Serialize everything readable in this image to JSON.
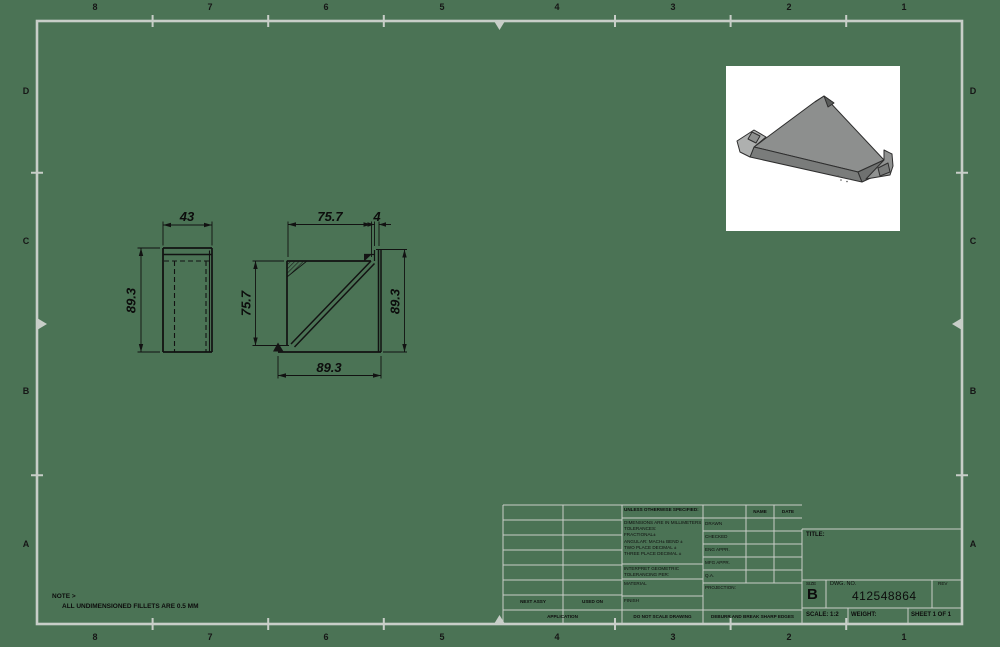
{
  "sheet": {
    "background_color": "#4b7355",
    "border_color": "#c8cec8",
    "line_color": "#121212",
    "zone_columns": [
      "8",
      "7",
      "6",
      "5",
      "4",
      "3",
      "2",
      "1"
    ],
    "zone_rows": [
      "D",
      "C",
      "B",
      "A"
    ]
  },
  "note": {
    "line1": "NOTE >",
    "line2": "ALL UNDIMENSIONED FILLETS ARE 0.5 MM"
  },
  "views": {
    "side_view": {
      "width_dim": "43",
      "height_dim": "89.3"
    },
    "front_view": {
      "top_dim": "75.7",
      "flange_dim": "4",
      "left_dim": "75.7",
      "right_dim": "89.3",
      "bottom_dim": "89.3"
    },
    "isometric": {
      "part": "triangular gusset plate with bent corner flanges"
    }
  },
  "title_block": {
    "tolerance_block": {
      "header": "UNLESS OTHERWISE SPECIFIED:",
      "tolerances_text": "DIMENSIONS ARE IN MILLIMETERS\nTOLERANCES:\nFRACTIONAL±\nANGULAR: MACH±   BEND ±\nTWO PLACE DECIMAL     ±\nTHREE PLACE DECIMAL  ±",
      "interpret_text": "INTERPRET GEOMETRIC\nTOLERANCING PER:",
      "material_label": "MATERIAL",
      "finish_label": "FINISH",
      "do_not_scale": "DO NOT SCALE DRAWING"
    },
    "approval": {
      "name_header": "NAME",
      "date_header": "DATE",
      "row_drawn": "DRAWN",
      "row_checked": "CHECKED",
      "row_eng": "ENG APPR.",
      "row_mfg": "MFG APPR.",
      "row_qa": "Q.A.",
      "projection_label": "PROJECTION:",
      "deburr": "DEBURR AND BREAK SHARP EDGES"
    },
    "application": {
      "next_assy": "NEXT ASSY",
      "used_on": "USED ON",
      "application_label": "APPLICATION"
    },
    "title_label": "TITLE:",
    "size_label": "SIZE",
    "size_value": "B",
    "dwg_label": "DWG.  NO.",
    "dwg_number": "412548864",
    "rev_label": "REV",
    "scale_label": "SCALE: 1:2",
    "weight_label": "WEIGHT:",
    "sheet_label": "SHEET 1 OF 1"
  }
}
